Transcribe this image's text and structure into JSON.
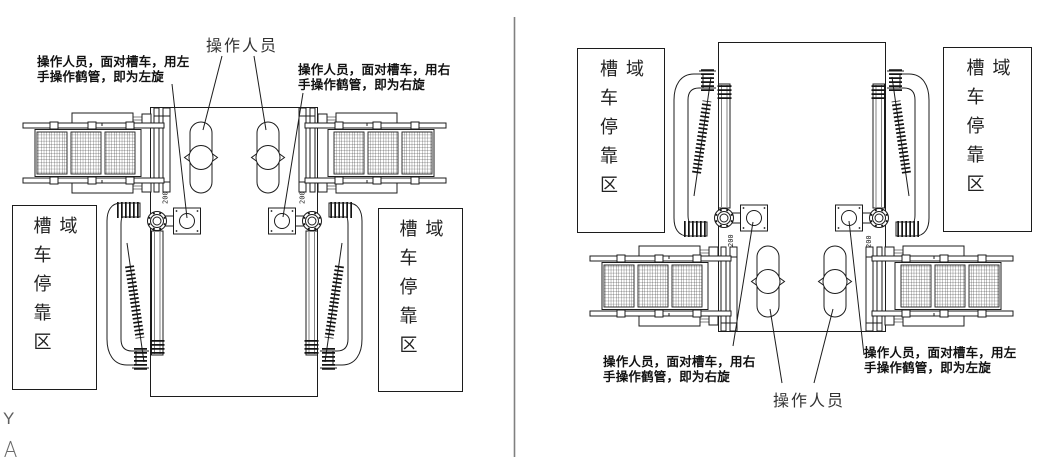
{
  "canvas": {
    "background": "#ffffff",
    "line_color": "#1c1c1c",
    "divider_color": "#808080"
  },
  "left_diagram": {
    "operators_label": "操作人员",
    "left_note": {
      "line1": "操作人员，面对槽车，用左",
      "line2": "手操作鹤管，即为左旋"
    },
    "right_note": {
      "line1": "操作人员，面对槽车，用右",
      "line2": "手操作鹤管，即为右旋"
    },
    "left_zone": "槽车停靠区域",
    "right_zone": "槽车停靠区域"
  },
  "right_diagram": {
    "operators_label": "操作人员",
    "left_note": {
      "line1": "操作人员，面对槽车，用右",
      "line2": "手操作鹤管，即为右旋"
    },
    "right_note": {
      "line1": "操作人员，面对槽车，用左",
      "line2": "手操作鹤管，即为左旋"
    },
    "left_zone": "槽车停靠区域",
    "right_zone": "槽车停靠区域"
  },
  "dimension_label": "200",
  "axis_label": "Y"
}
